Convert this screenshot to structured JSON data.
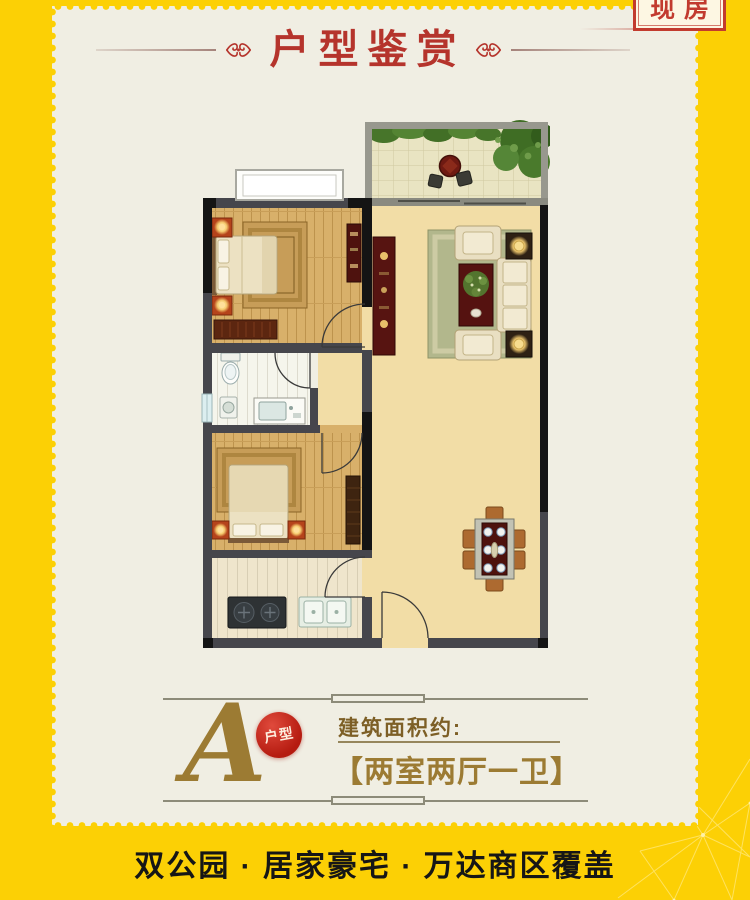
{
  "badge": {
    "label": "现房"
  },
  "header": {
    "title": "户型鉴赏"
  },
  "unit": {
    "letter": "A",
    "letter_badge": "户型",
    "area_label": "建筑面积约:",
    "layout": "【两室两厅一卫】"
  },
  "slogan": "双公园 · 居家豪宅 · 万达商区覆盖",
  "floor_plan": {
    "rooms": [
      "balcony",
      "living-dining-room",
      "bedroom-1",
      "bedroom-2",
      "bathroom",
      "kitchen",
      "hallway"
    ],
    "furniture": [
      "balcony-tea-table-and-chairs",
      "double-bed",
      "bedside-lamp-tables",
      "low-dresser",
      "tv-cabinet",
      "sofa-set-with-rug",
      "coffee-table-with-plant",
      "corner-lamp-tables",
      "dining-table-with-six-chairs",
      "toilet",
      "washing-machine",
      "wash-basin",
      "wardrobe",
      "two-burner-stove",
      "double-kitchen-sink"
    ]
  },
  "theme": {
    "yellow": "#fcd005",
    "cream": "#f0eee3",
    "red": "#b5342c",
    "badge-red": "#c23b2e",
    "gold": "#9c7b33",
    "ink": "#161616",
    "rule": "#8d8b79"
  }
}
